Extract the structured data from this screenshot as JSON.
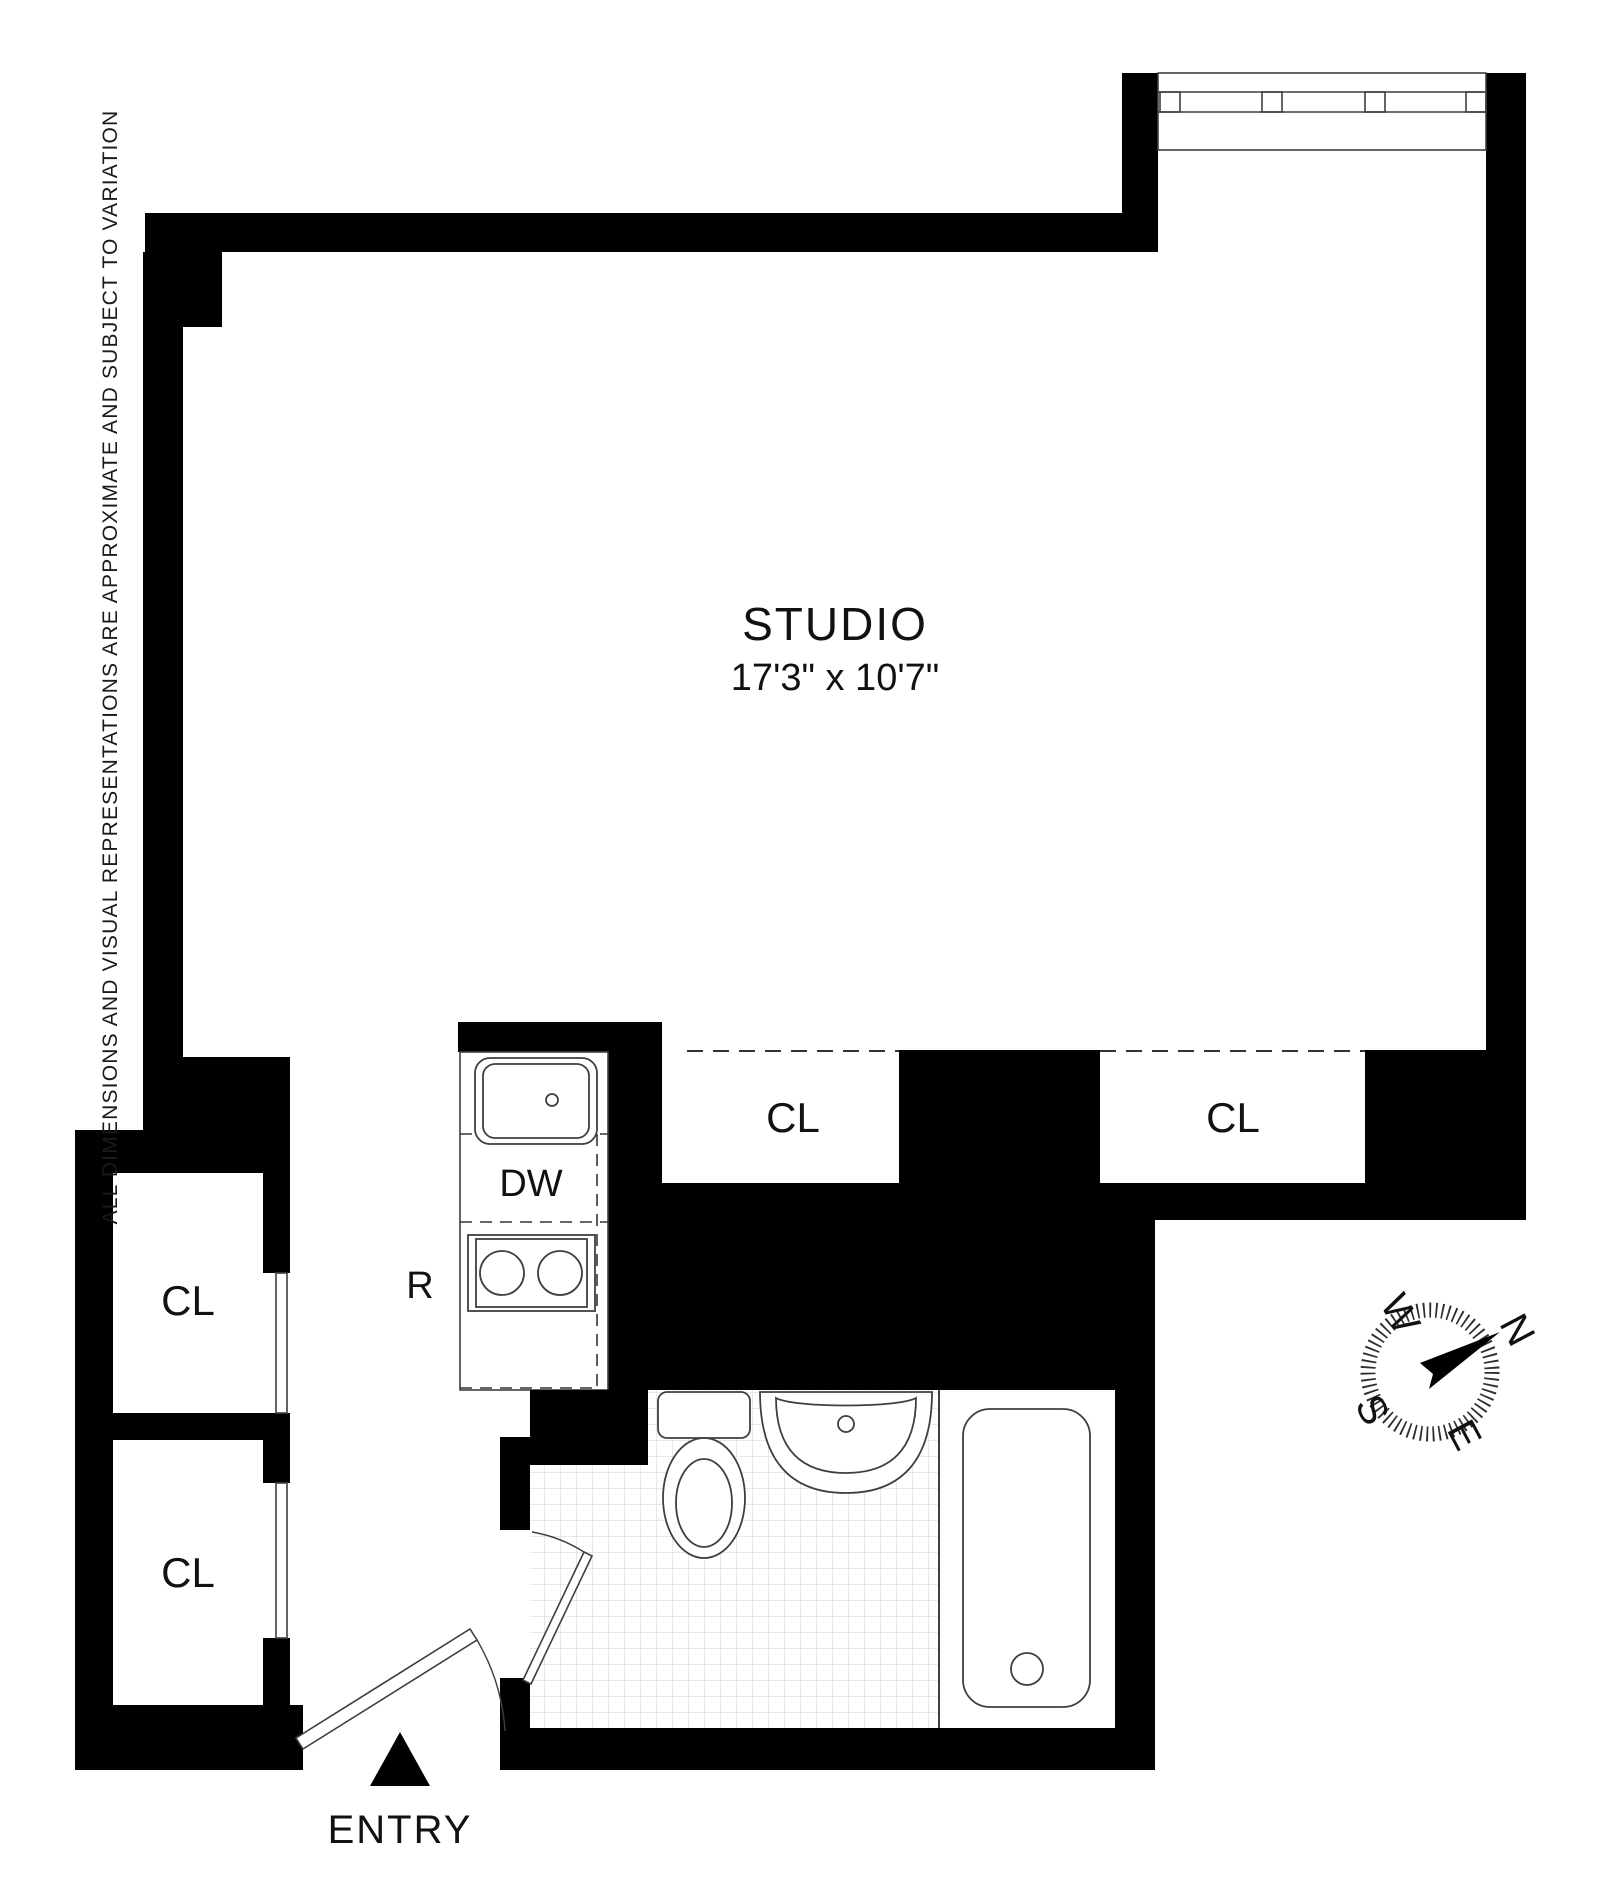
{
  "title": "Studio apartment floor plan",
  "disclaimer": "ALL DIMENSIONS AND VISUAL REPRESENTATIONS ARE APPROXIMATE AND SUBJECT TO VARIATION",
  "rooms": {
    "studio": {
      "name": "STUDIO",
      "dimensions": "17'3\" x 10'7\""
    },
    "closets": [
      {
        "label": "CL"
      },
      {
        "label": "CL"
      },
      {
        "label": "CL"
      },
      {
        "label": "CL"
      }
    ]
  },
  "kitchen": {
    "dishwasher_label": "DW",
    "range_label": "R"
  },
  "entry": {
    "label": "ENTRY"
  },
  "compass": {
    "north": "N",
    "south": "S",
    "east": "E",
    "west": "W"
  },
  "colors": {
    "wall": "#000000",
    "fixture_line": "#3f3f3f",
    "tile_line": "#d9d9d9",
    "background": "#ffffff"
  }
}
